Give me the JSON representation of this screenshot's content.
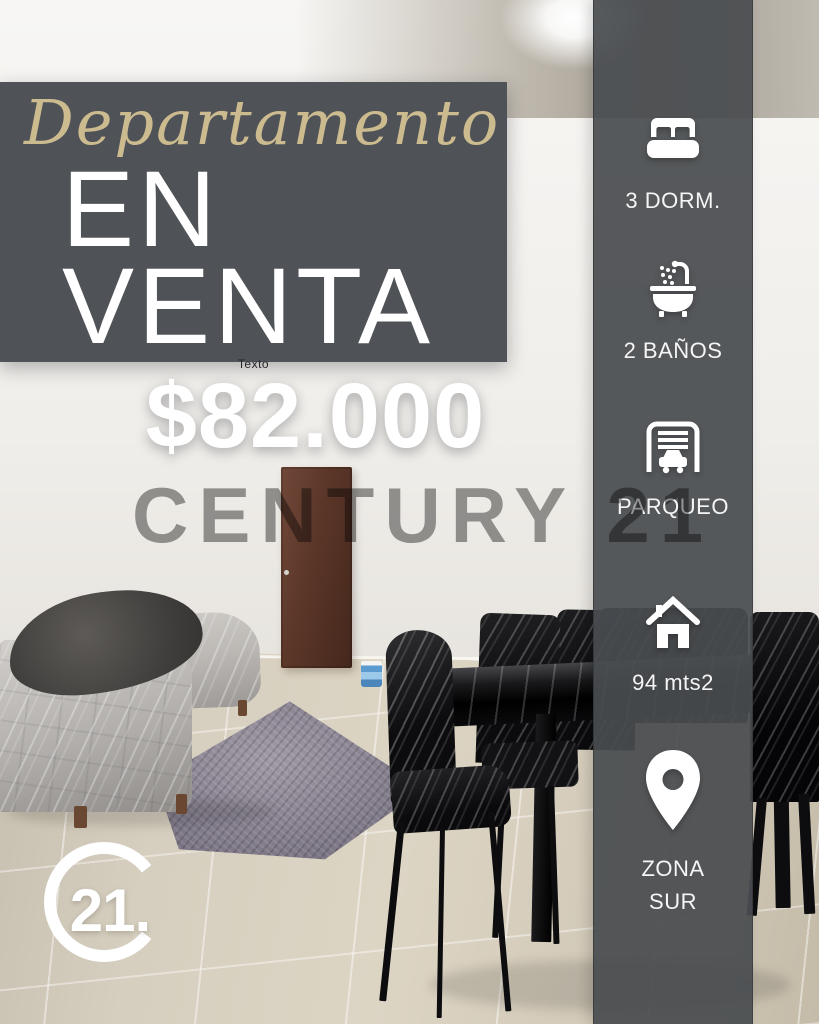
{
  "title": {
    "script": "Departamento",
    "line1": "EN",
    "line2": "VENTA"
  },
  "price": {
    "small_label": "Texto",
    "value": "$82.000"
  },
  "watermark": {
    "text": "CENTURY 21"
  },
  "sidebar": {
    "items": [
      {
        "icon": "bed-icon",
        "label": "3 DORM."
      },
      {
        "icon": "bath-icon",
        "label": "2 BAÑOS"
      },
      {
        "icon": "garage-icon",
        "label": "PARQUEO"
      },
      {
        "icon": "house-icon",
        "label": "94 mts2"
      },
      {
        "icon": "location-pin-icon",
        "label": "ZONA SUR",
        "line1": "ZONA",
        "line2": "SUR"
      }
    ]
  },
  "logo": {
    "text": "21."
  },
  "colors": {
    "accent_gold": "#CDBB90",
    "panel_gray": "#4F5256",
    "sidebar_gray": "#494C50",
    "watermark_gray": "#9A9A9A",
    "text_white": "#FFFFFF"
  }
}
